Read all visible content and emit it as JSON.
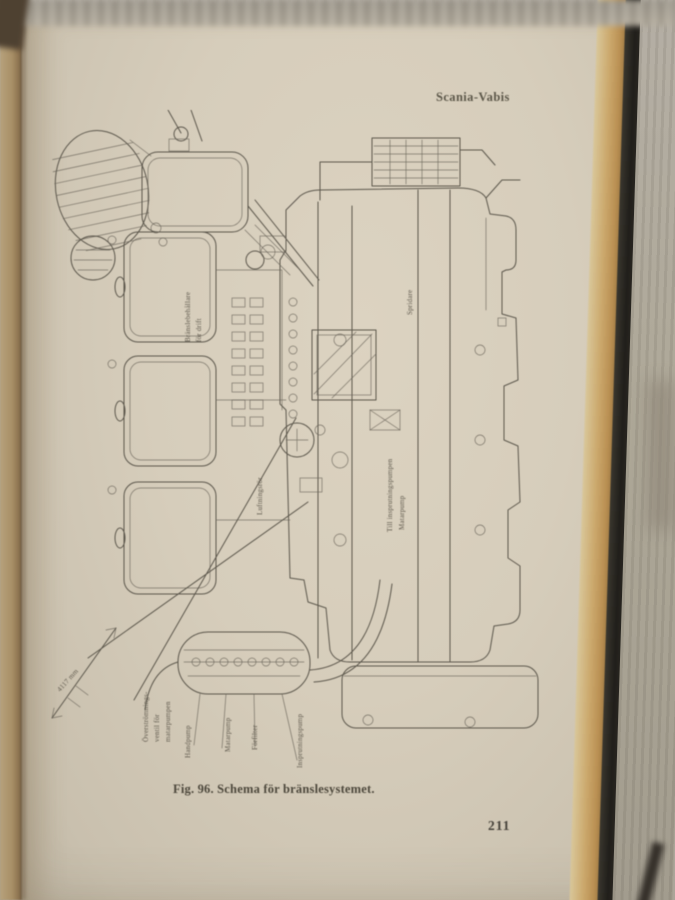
{
  "photo": {
    "background_color": "#b3ada3",
    "page_color": "#d6cdbb",
    "fore_edge_color": "#cba86c",
    "cover_color": "#201e1a",
    "ink_color": "#5c574c"
  },
  "page": {
    "running_head": "Scania-Vabis",
    "caption": "Fig. 96.  Schema för bränslesystemet.",
    "page_number": "211"
  },
  "diagram": {
    "figure_subject": "fuel-system-schematic-rotated-90",
    "labels": {
      "l1a": "Bränslebehållare",
      "l1b": "för drift",
      "l2": "Luftningsrör",
      "l3": "Spridare",
      "l4a": "Till insprutningspumpen",
      "l4b": "Matarpump",
      "l5a": "Överströmnings-",
      "l5b": "ventil för",
      "l5c": "matarpumpen",
      "l6": "Handpump",
      "l7": "Matarpump",
      "l8": "Förfilter",
      "l9": "Insprutningspump",
      "l10": "4117 mm"
    }
  }
}
